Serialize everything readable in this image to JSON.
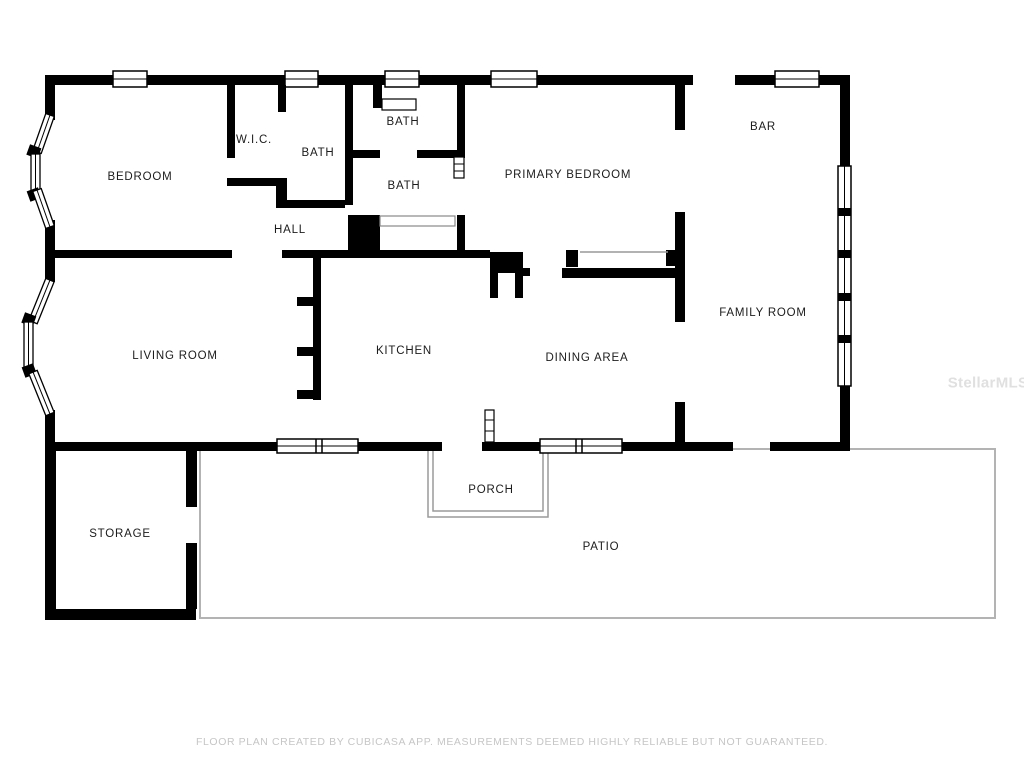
{
  "rooms": [
    {
      "name": "BEDROOM",
      "x": 140,
      "y": 177
    },
    {
      "name": "W.I.C.",
      "x": 254,
      "y": 140
    },
    {
      "name": "BATH",
      "x": 318,
      "y": 153
    },
    {
      "name": "BATH",
      "x": 403,
      "y": 122
    },
    {
      "name": "BATH",
      "x": 404,
      "y": 186
    },
    {
      "name": "HALL",
      "x": 290,
      "y": 230
    },
    {
      "name": "PRIMARY BEDROOM",
      "x": 568,
      "y": 175
    },
    {
      "name": "BAR",
      "x": 763,
      "y": 127
    },
    {
      "name": "LIVING ROOM",
      "x": 175,
      "y": 356
    },
    {
      "name": "KITCHEN",
      "x": 404,
      "y": 351
    },
    {
      "name": "DINING AREA",
      "x": 587,
      "y": 358
    },
    {
      "name": "FAMILY ROOM",
      "x": 763,
      "y": 313
    },
    {
      "name": "STORAGE",
      "x": 120,
      "y": 534
    },
    {
      "name": "PORCH",
      "x": 491,
      "y": 490
    },
    {
      "name": "PATIO",
      "x": 601,
      "y": 547
    }
  ],
  "watermark": "StellarMLS",
  "disclaimer": "FLOOR PLAN CREATED BY CUBICASA APP. MEASUREMENTS DEEMED HIGHLY RELIABLE BUT NOT GUARANTEED.",
  "colors": {
    "wall": "#000000",
    "window_fill": "#ffffff",
    "patio_line": "#b3b3b3",
    "porch_line": "#9a9a9a",
    "disclaimer_text": "#c6c6c6",
    "watermark_text": "#e0e0e0"
  }
}
